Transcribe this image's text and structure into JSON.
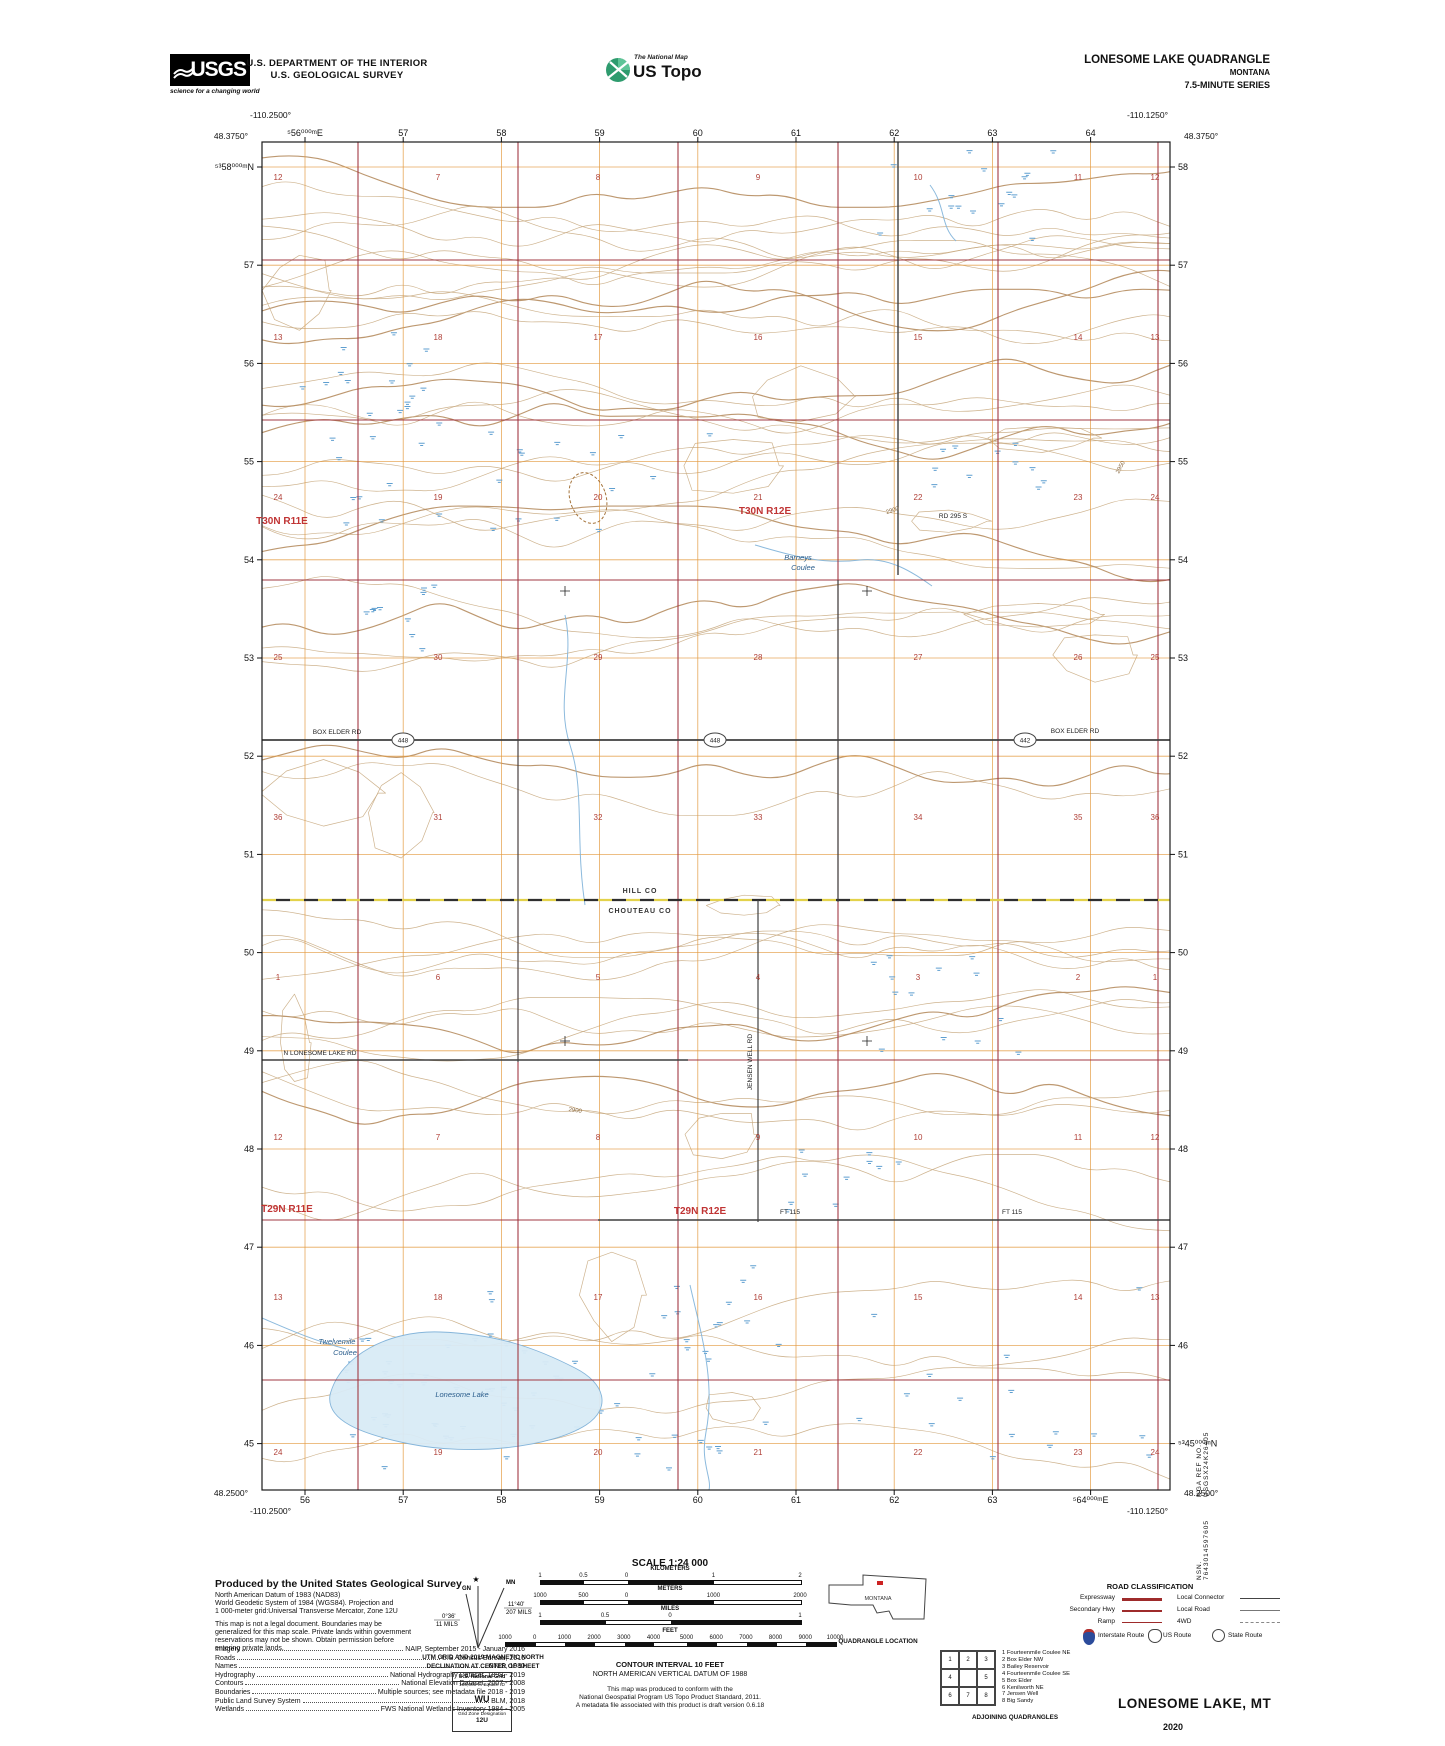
{
  "header": {
    "usgs_logo_text": "USGS",
    "usgs_tagline": "science for a changing world",
    "dept_line1": "U.S. DEPARTMENT OF THE INTERIOR",
    "dept_line2": "U.S. GEOLOGICAL SURVEY",
    "natmap_label": "The National Map",
    "ustopo_label": "US Topo",
    "quad_title": "LONESOME LAKE QUADRANGLE",
    "quad_state": "MONTANA",
    "quad_series": "7.5-MINUTE SERIES"
  },
  "map": {
    "corners": {
      "tl_lat": "48.3750°",
      "tl_lon": "-110.2500°",
      "tr_lat": "48.3750°",
      "tr_lon": "-110.1250°",
      "bl_lat": "48.2500°",
      "bl_lon": "-110.2500°",
      "br_lat": "48.2500°",
      "br_lon": "-110.1250°"
    },
    "top_labels": [
      "⁵56⁰⁰⁰ᵐE",
      "57",
      "58",
      "59",
      "60",
      "61",
      "62",
      "63",
      "64"
    ],
    "bottom_labels": [
      "56",
      "57",
      "58",
      "59",
      "60",
      "61",
      "62",
      "63",
      "⁵64⁰⁰⁰ᵐE"
    ],
    "left_labels": [
      "⁵³58⁰⁰⁰ᵐN",
      "57",
      "56",
      "55",
      "54",
      "53",
      "52",
      "51",
      "50",
      "49",
      "48",
      "47",
      "46",
      "45"
    ],
    "right_labels": [
      "58",
      "57",
      "56",
      "55",
      "54",
      "53",
      "52",
      "51",
      "50",
      "49",
      "48",
      "47",
      "46",
      "⁵³45⁰⁰⁰ᵐN"
    ],
    "township_labels": [
      {
        "text": "T30N R11E",
        "x": 282,
        "y": 524
      },
      {
        "text": "T30N R12E",
        "x": 765,
        "y": 514
      },
      {
        "text": "T29N R11E",
        "x": 287,
        "y": 1212
      },
      {
        "text": "T29N R12E",
        "x": 700,
        "y": 1214
      }
    ],
    "section_cols": [
      278,
      438,
      598,
      758,
      918,
      1078,
      1155
    ],
    "section_rows": [
      {
        "y": 180,
        "nums": [
          "12",
          "7",
          "8",
          "9",
          "10",
          "11",
          "12"
        ]
      },
      {
        "y": 340,
        "nums": [
          "13",
          "18",
          "17",
          "16",
          "15",
          "14",
          "13"
        ]
      },
      {
        "y": 500,
        "nums": [
          "24",
          "19",
          "20",
          "21",
          "22",
          "23",
          "24"
        ]
      },
      {
        "y": 660,
        "nums": [
          "25",
          "30",
          "29",
          "28",
          "27",
          "26",
          "25"
        ]
      },
      {
        "y": 820,
        "nums": [
          "36",
          "31",
          "32",
          "33",
          "34",
          "35",
          "36"
        ]
      },
      {
        "y": 980,
        "nums": [
          "1",
          "6",
          "5",
          "4",
          "3",
          "2",
          "1"
        ]
      },
      {
        "y": 1140,
        "nums": [
          "12",
          "7",
          "8",
          "9",
          "10",
          "11",
          "12"
        ]
      },
      {
        "y": 1300,
        "nums": [
          "13",
          "18",
          "17",
          "16",
          "15",
          "14",
          "13"
        ]
      },
      {
        "y": 1455,
        "nums": [
          "24",
          "19",
          "20",
          "21",
          "22",
          "23",
          "24"
        ]
      }
    ],
    "county_boundary": {
      "upper": "HILL CO",
      "lower": "CHOUTEAU CO"
    },
    "road_labels": [
      {
        "text": "BOX ELDER RD",
        "x": 337,
        "y": 734,
        "rot": 0
      },
      {
        "text": "BOX ELDER RD",
        "x": 1075,
        "y": 733,
        "rot": 0
      },
      {
        "text": "N LONESOME LAKE RD",
        "x": 320,
        "y": 1055,
        "rot": 0
      },
      {
        "text": "FT 115",
        "x": 790,
        "y": 1214,
        "rot": 0
      },
      {
        "text": "FT 115",
        "x": 1012,
        "y": 1214,
        "rot": 0
      },
      {
        "text": "RD 295 S",
        "x": 953,
        "y": 518,
        "rot": 0
      },
      {
        "text": "JENSEN WELL RD",
        "x": 752,
        "y": 1062,
        "rot": -90
      }
    ],
    "route_markers": [
      {
        "text": "448",
        "x": 403,
        "y": 740
      },
      {
        "text": "448",
        "x": 715,
        "y": 740
      },
      {
        "text": "442",
        "x": 1025,
        "y": 740
      }
    ],
    "water_labels": [
      {
        "text": "Barneys",
        "x": 798,
        "y": 560
      },
      {
        "text": "Coulee",
        "x": 803,
        "y": 570
      },
      {
        "text": "Twelvemile",
        "x": 337,
        "y": 1344
      },
      {
        "text": "Coulee",
        "x": 345,
        "y": 1355
      },
      {
        "text": "Lonesome Lake",
        "x": 462,
        "y": 1397
      }
    ],
    "contour_labels": [
      {
        "text": "2900",
        "x": 893,
        "y": 512,
        "rot": -18
      },
      {
        "text": "2900",
        "x": 575,
        "y": 1112,
        "rot": 8
      },
      {
        "text": "2950",
        "x": 1122,
        "y": 468,
        "rot": -62
      }
    ]
  },
  "footer": {
    "produced_by": "Produced by the United States Geological Survey",
    "intro_lines": [
      "North American Datum of 1983 (NAD83)",
      "World Geodetic System of 1984 (WGS84).  Projection and",
      "1 000-meter grid:Universal Transverse Mercator, Zone 12U",
      "",
      "This map is not a legal document. Boundaries may be",
      "generalized for this map scale. Private lands within government",
      "reservations may not be shown. Obtain permission before",
      "entering private lands."
    ],
    "sources": [
      {
        "label": "Imagery",
        "value": "NAIP, September 2015 - January 2016"
      },
      {
        "label": "Roads",
        "value": "U.S. Census Bureau, 2016"
      },
      {
        "label": "Names",
        "value": "GNIS, 1980"
      },
      {
        "label": "Hydrography",
        "value": "National Hydrography Dataset, 1899 - 2019"
      },
      {
        "label": "Contours",
        "value": "National Elevation Dataset, 2007 - 2008"
      },
      {
        "label": "Boundaries",
        "value": "Multiple sources; see metadata file 2018 - 2019"
      },
      {
        "label": "Public Land Survey System",
        "value": "BLM, 2018"
      },
      {
        "label": "Wetlands",
        "value": "FWS National Wetlands Inventory 1984 - 2005"
      }
    ],
    "declination": {
      "caption1": "UTM GRID AND 2019 MAGNETIC NORTH",
      "caption2": "DECLINATION AT CENTER OF SHEET",
      "gn": "GN",
      "mn": "MN",
      "star": "★",
      "gn_deg": "0°36'",
      "gn_mils": "11 MILS",
      "mn_deg": "11°40'",
      "mn_mils": "207 MILS"
    },
    "usng": {
      "title": "U.S. National Grid",
      "sub": "100,000-m Square ID",
      "square": "WU",
      "gzd_label": "Grid Zone Designation",
      "gzd": "12U"
    },
    "scale": {
      "title": "SCALE 1:24 000",
      "bars": [
        {
          "name": "KILOMETERS",
          "labels": [
            "1",
            "0.5",
            "0",
            "1",
            "2"
          ],
          "fracs": [
            0,
            0.167,
            0.333,
            0.667,
            1
          ]
        },
        {
          "name": "METERS",
          "labels": [
            "1000",
            "500",
            "0",
            "1000",
            "2000"
          ],
          "fracs": [
            0,
            0.167,
            0.333,
            0.667,
            1
          ]
        },
        {
          "name": "MILES",
          "labels": [
            "1",
            "0.5",
            "0",
            "1"
          ],
          "fracs": [
            0,
            0.25,
            0.5,
            1
          ]
        },
        {
          "name": "FEET",
          "labels": [
            "1000",
            "0",
            "1000",
            "2000",
            "3000",
            "4000",
            "5000",
            "6000",
            "7000",
            "8000",
            "9000",
            "10000"
          ],
          "fracs": [
            0,
            0.09,
            0.18,
            0.27,
            0.36,
            0.45,
            0.55,
            0.64,
            0.73,
            0.82,
            0.91,
            1
          ]
        }
      ]
    },
    "contour_interval": "CONTOUR INTERVAL 10 FEET",
    "datum_line": "NORTH AMERICAN VERTICAL DATUM OF 1988",
    "conform_lines": [
      "This map was produced to conform with the",
      "National Geospatial Program US Topo Product Standard, 2011.",
      "A metadata file associated with this product is draft version 0.6.18"
    ],
    "state_name": "MONTANA",
    "quad_location_caption": "QUADRANGLE LOCATION",
    "adjoining": {
      "cells": [
        "1",
        "2",
        "3",
        "4",
        "",
        "5",
        "6",
        "7",
        "8"
      ],
      "caption": "ADJOINING QUADRANGLES",
      "list": [
        "1 Fourteenmile Coulee NE",
        "2 Box Elder NW",
        "3 Bailey Reservoir",
        "4 Fourteenmile Coulee SE",
        "5 Box Elder",
        "6 Kenilworth NE",
        "7 Jensen Well",
        "8 Big Sandy"
      ]
    },
    "road_class": {
      "title": "ROAD CLASSIFICATION",
      "left": [
        {
          "label": "Expressway",
          "style": "expressway"
        },
        {
          "label": "Secondary Hwy",
          "style": "secondary"
        },
        {
          "label": "Ramp",
          "style": "ramp"
        }
      ],
      "right": [
        {
          "label": "Local Connector",
          "style": "connector"
        },
        {
          "label": "Local Road",
          "style": "local"
        },
        {
          "label": "4WD",
          "style": "fourwd"
        }
      ],
      "shields": [
        {
          "label": "Interstate Route",
          "type": "interstate"
        },
        {
          "label": "US Route",
          "type": "us"
        },
        {
          "label": "State Route",
          "type": "state"
        }
      ]
    },
    "sheet_title": "LONESOME LAKE,  MT",
    "sheet_year": "2020"
  },
  "margin": {
    "nsn": "NSN. 7643014597605",
    "nga": "NGA REF NO. USGSX24K26405"
  },
  "colors": {
    "contour": "#c9ab82",
    "contour_index": "#b68d60",
    "utm_grid": "#e39a3f",
    "section_line": "#9e3039",
    "road": "#3f3f3f",
    "water": "#7fb2d9",
    "lake_fill": "#d9ebf6",
    "marsh": "#5f9fd0",
    "red_text": "#b04038",
    "township_text": "#c03434",
    "county_yellow": "#e3d24b"
  }
}
